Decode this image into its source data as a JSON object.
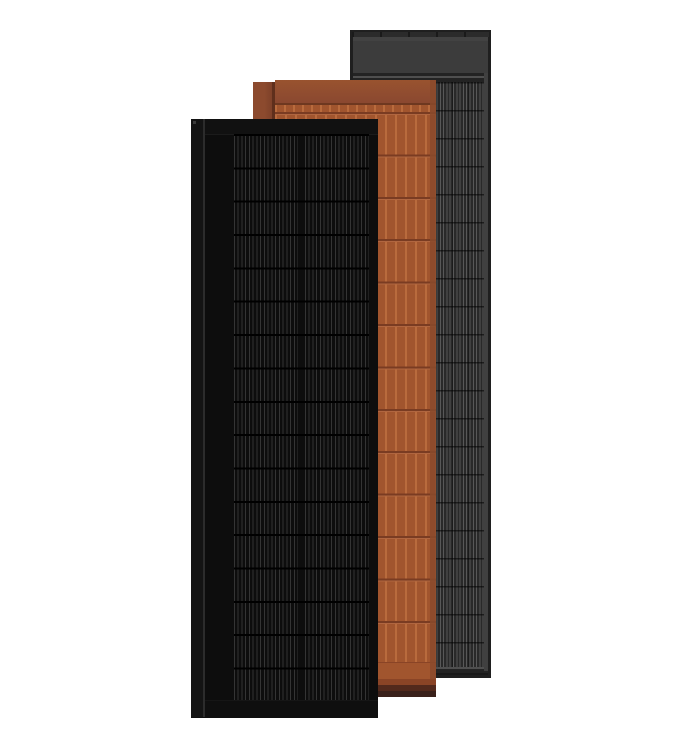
{
  "scene": {
    "description": "Product render of three overlapping rectangular solar panels on a white background",
    "panels": [
      {
        "id": "graphite",
        "name": "Graphite grey solar panel",
        "position": "back right",
        "features": [
          "dark outer frame",
          "plain grey header band",
          "thin mounting rail line",
          "vertically striped photovoltaic cell field with horizontal row seams",
          "lighter right frame edge"
        ]
      },
      {
        "id": "terracotta",
        "name": "Terracotta tile-look solar panel",
        "position": "middle",
        "features": [
          "clay-red ridged tile rows",
          "plain header band",
          "shaded left side flange",
          "dark stepped bottom lip"
        ]
      },
      {
        "id": "black",
        "name": "All-black solar panel",
        "position": "front left",
        "features": [
          "narrow left side flange with highlight seam",
          "black top frame band",
          "two columns of finely striped solar cells with horizontal row dividers",
          "black bottom frame band"
        ]
      }
    ]
  },
  "colors": {
    "bg": "#ffffff",
    "g-frame": "#1f1f1f",
    "g-top": "#2b2b2b",
    "g-seam": "#1a1a1a",
    "g-header": "#3c3c3c",
    "g-railbg": "#232323",
    "g-rail": "#4f4f4f",
    "g-cellbg": "#292929",
    "g-line": "#585858",
    "g-edge": "#404040",
    "t-face": "#a1552e",
    "t-ridge": "#b96b3d",
    "t-row": "#7a3c22",
    "t-rowlight": "#b06640",
    "t-headline": "#6e3820",
    "t-side": "#7e4129",
    "t-seam": "#5f2f1c",
    "t-edge": "#8a4a2c",
    "t-lip1": "#8a4426",
    "t-lip2": "#52291c",
    "t-lip3": "#3a211b",
    "b-frame": "#101010",
    "b-face": "#0d0d0d",
    "b-line": "#343434",
    "b-row": "#000000",
    "b-flange": "#141414",
    "b-flangeline": "#2c2c2c",
    "b-notch": "#3b3b3b"
  }
}
